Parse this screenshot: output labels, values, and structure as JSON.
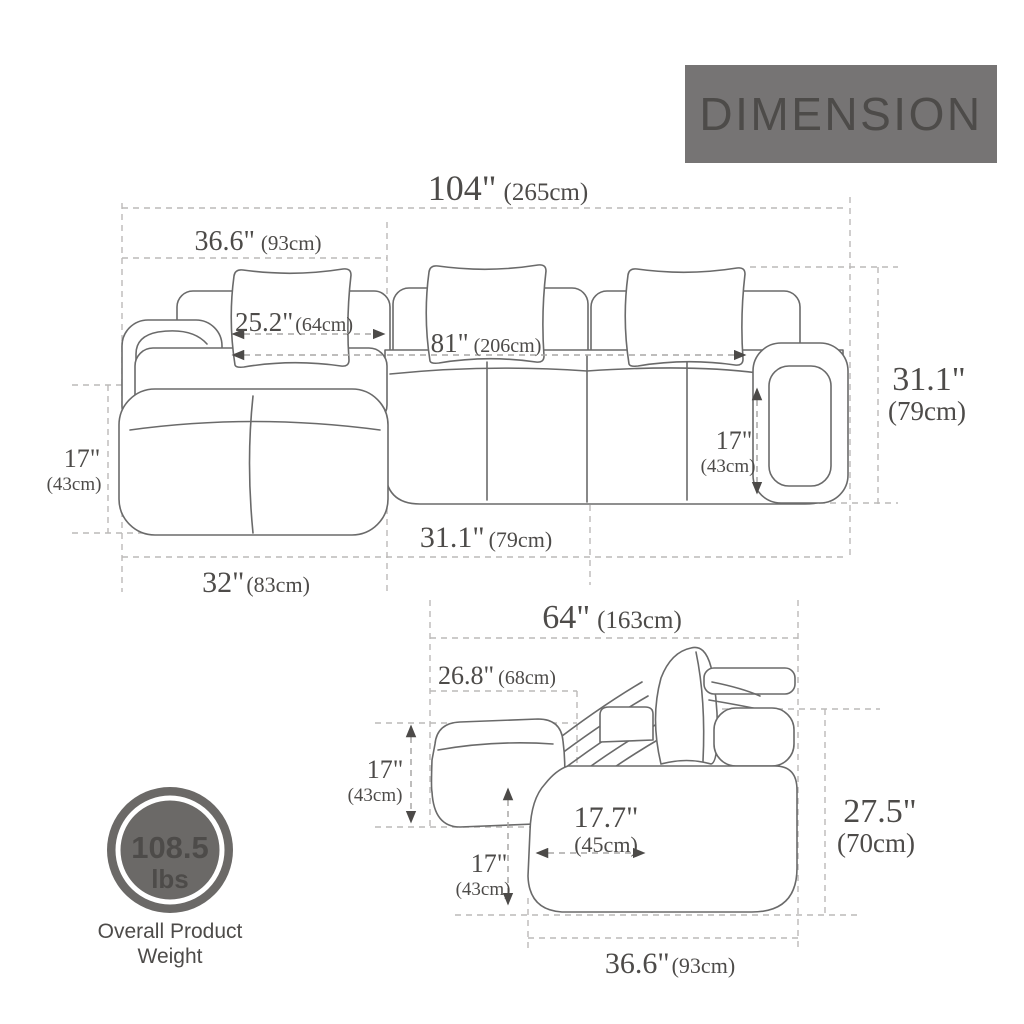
{
  "header": {
    "title": "DIMENSION"
  },
  "colors": {
    "banner": "#767474",
    "badge": "#6b6967",
    "line": "#6a6a6a",
    "dash": "#bcbab8",
    "text": "#4d4b49"
  },
  "top_view": {
    "overall_width": {
      "in": "104\"",
      "cm": "(265cm)"
    },
    "chaise_width": {
      "in": "36.6\"",
      "cm": "(93cm)"
    },
    "arm_to_chaise": {
      "in": "25.2\"",
      "cm": "(64cm)"
    },
    "interior_width": {
      "in": "81\"",
      "cm": "(206cm)"
    },
    "overall_height": {
      "in": "31.1\"",
      "cm": "(79cm)"
    },
    "chaise_seat_width": {
      "in": "17\"",
      "cm": "(43cm)"
    },
    "seat_depth": {
      "in": "17\"",
      "cm": "(43cm)"
    },
    "seat_module_depth": {
      "in": "31.1\"",
      "cm": "(79cm)"
    },
    "chaise_length": {
      "in": "32\"",
      "cm": "(83cm)"
    }
  },
  "side_view": {
    "overall_depth": {
      "in": "64\"",
      "cm": "(163cm)"
    },
    "chaise_extension": {
      "in": "26.8\"",
      "cm": "(68cm)"
    },
    "ottoman_height": {
      "in": "17\"",
      "cm": "(43cm)"
    },
    "seat_depth": {
      "in": "17.7\"",
      "cm": "(45cm)"
    },
    "seat_height": {
      "in": "17\"",
      "cm": "(43cm)"
    },
    "overall_height": {
      "in": "27.5\"",
      "cm": "(70cm)"
    },
    "base_depth": {
      "in": "36.6\"",
      "cm": "(93cm)"
    }
  },
  "weight_badge": {
    "value": "108.5",
    "unit": "lbs",
    "caption_line1": "Overall Product",
    "caption_line2": "Weight"
  }
}
